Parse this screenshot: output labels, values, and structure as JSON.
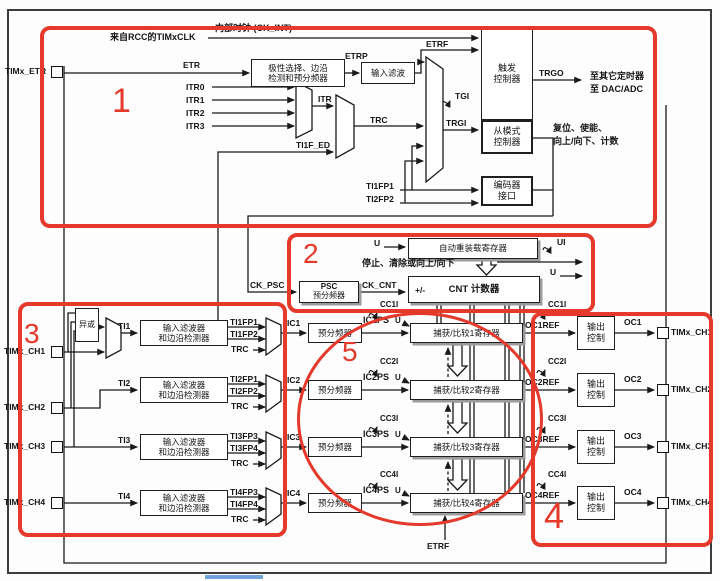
{
  "annotations": {
    "color": "#e5392b",
    "n1": "1",
    "n2": "2",
    "n3": "3",
    "n4": "4",
    "n5": "5"
  },
  "clock": {
    "internal": "内部时钟 (CK_INT)",
    "from_rcc": "来自RCC的TIMxCLK"
  },
  "etr": {
    "port": "TIMx_ETR",
    "sig": "ETR",
    "polarity_l1": "极性选择、边沿",
    "polarity_l2": "检测和预分频器",
    "etrp": "ETRP",
    "filter": "输入滤波",
    "etrf": "ETRF",
    "etrf_bottom": "ETRF"
  },
  "trigger": {
    "itr0": "ITR0",
    "itr1": "ITR1",
    "itr2": "ITR2",
    "itr3": "ITR3",
    "itr": "ITR",
    "ti1f_ed": "TI1F_ED",
    "trc": "TRC",
    "tgi": "TGI",
    "trgi": "TRGI",
    "box_l1": "触发",
    "box_l2": "控制器",
    "trgo": "TRGO",
    "dest_l1": "至其它定时器",
    "dest_l2": "至 DAC/ADC",
    "slave_l1": "从模式",
    "slave_l2": "控制器",
    "actions_l1": "复位、使能、",
    "actions_l2": "向上/向下、计数",
    "ti1fp1": "TI1FP1",
    "ti2fp2": "TI2FP2",
    "encoder_l1": "编码器",
    "encoder_l2": "接口"
  },
  "core": {
    "u": "U",
    "autoreload": "自动重装载寄存器",
    "ui": "UI",
    "stop_text": "停止、清除或向上/向下",
    "ck_psc": "CK_PSC",
    "psc_l1": "PSC",
    "psc_l2": "预分频器",
    "ck_cnt": "CK_CNT",
    "pm": "+/-",
    "cnt": "CNT 计数器"
  },
  "xor_label": "异或",
  "channels": [
    {
      "port": "TIMx_CH1",
      "ti": "TI1",
      "f1": "输入滤波器",
      "f2": "和边沿检测器",
      "fpa": "TI1FP1",
      "fpb": "TI1FP2",
      "trc": "TRC",
      "ic": "IC1",
      "icps": "IC1PS",
      "cci": "CC1I",
      "u": "U",
      "presc": "预分频器",
      "reg": "捕获/比较1寄存器",
      "ref": "OC1REF",
      "out_cci": "CC1I",
      "oc_l1": "输出",
      "oc_l2": "控制",
      "oc": "OC1",
      "out_port": "TIMx_CH1"
    },
    {
      "port": "TIMx_CH2",
      "ti": "TI2",
      "f1": "输入滤波器",
      "f2": "和边沿检测器",
      "fpa": "TI2FP1",
      "fpb": "TI2FP2",
      "trc": "TRC",
      "ic": "IC2",
      "icps": "IC2PS",
      "cci": "CC2I",
      "u": "U",
      "presc": "预分频器",
      "reg": "捕获/比较2寄存器",
      "ref": "OC2REF",
      "out_cci": "CC2I",
      "oc_l1": "输出",
      "oc_l2": "控制",
      "oc": "OC2",
      "out_port": "TIMx_CH2"
    },
    {
      "port": "TIMx_CH3",
      "ti": "TI3",
      "f1": "输入滤波器",
      "f2": "和边沿检测器",
      "fpa": "TI3FP3",
      "fpb": "TI3FP4",
      "trc": "TRC",
      "ic": "IC3",
      "icps": "IC3PS",
      "cci": "CC3I",
      "u": "U",
      "presc": "预分频器",
      "reg": "捕获/比较3寄存器",
      "ref": "OC3REF",
      "out_cci": "CC3I",
      "oc_l1": "输出",
      "oc_l2": "控制",
      "oc": "OC3",
      "out_port": "TIMx_CH3"
    },
    {
      "port": "TIMx_CH4",
      "ti": "TI4",
      "f1": "输入滤波器",
      "f2": "和边沿检测器",
      "fpa": "TI4FP3",
      "fpb": "TI4FP4",
      "trc": "TRC",
      "ic": "IC4",
      "icps": "IC4PS",
      "cci": "CC4I",
      "u": "U",
      "presc": "预分频器",
      "reg": "捕获/比较4寄存器",
      "ref": "OC4REF",
      "out_cci": "CC4I",
      "oc_l1": "输出",
      "oc_l2": "控制",
      "oc": "OC4",
      "out_port": "TIMx_CH4"
    }
  ]
}
